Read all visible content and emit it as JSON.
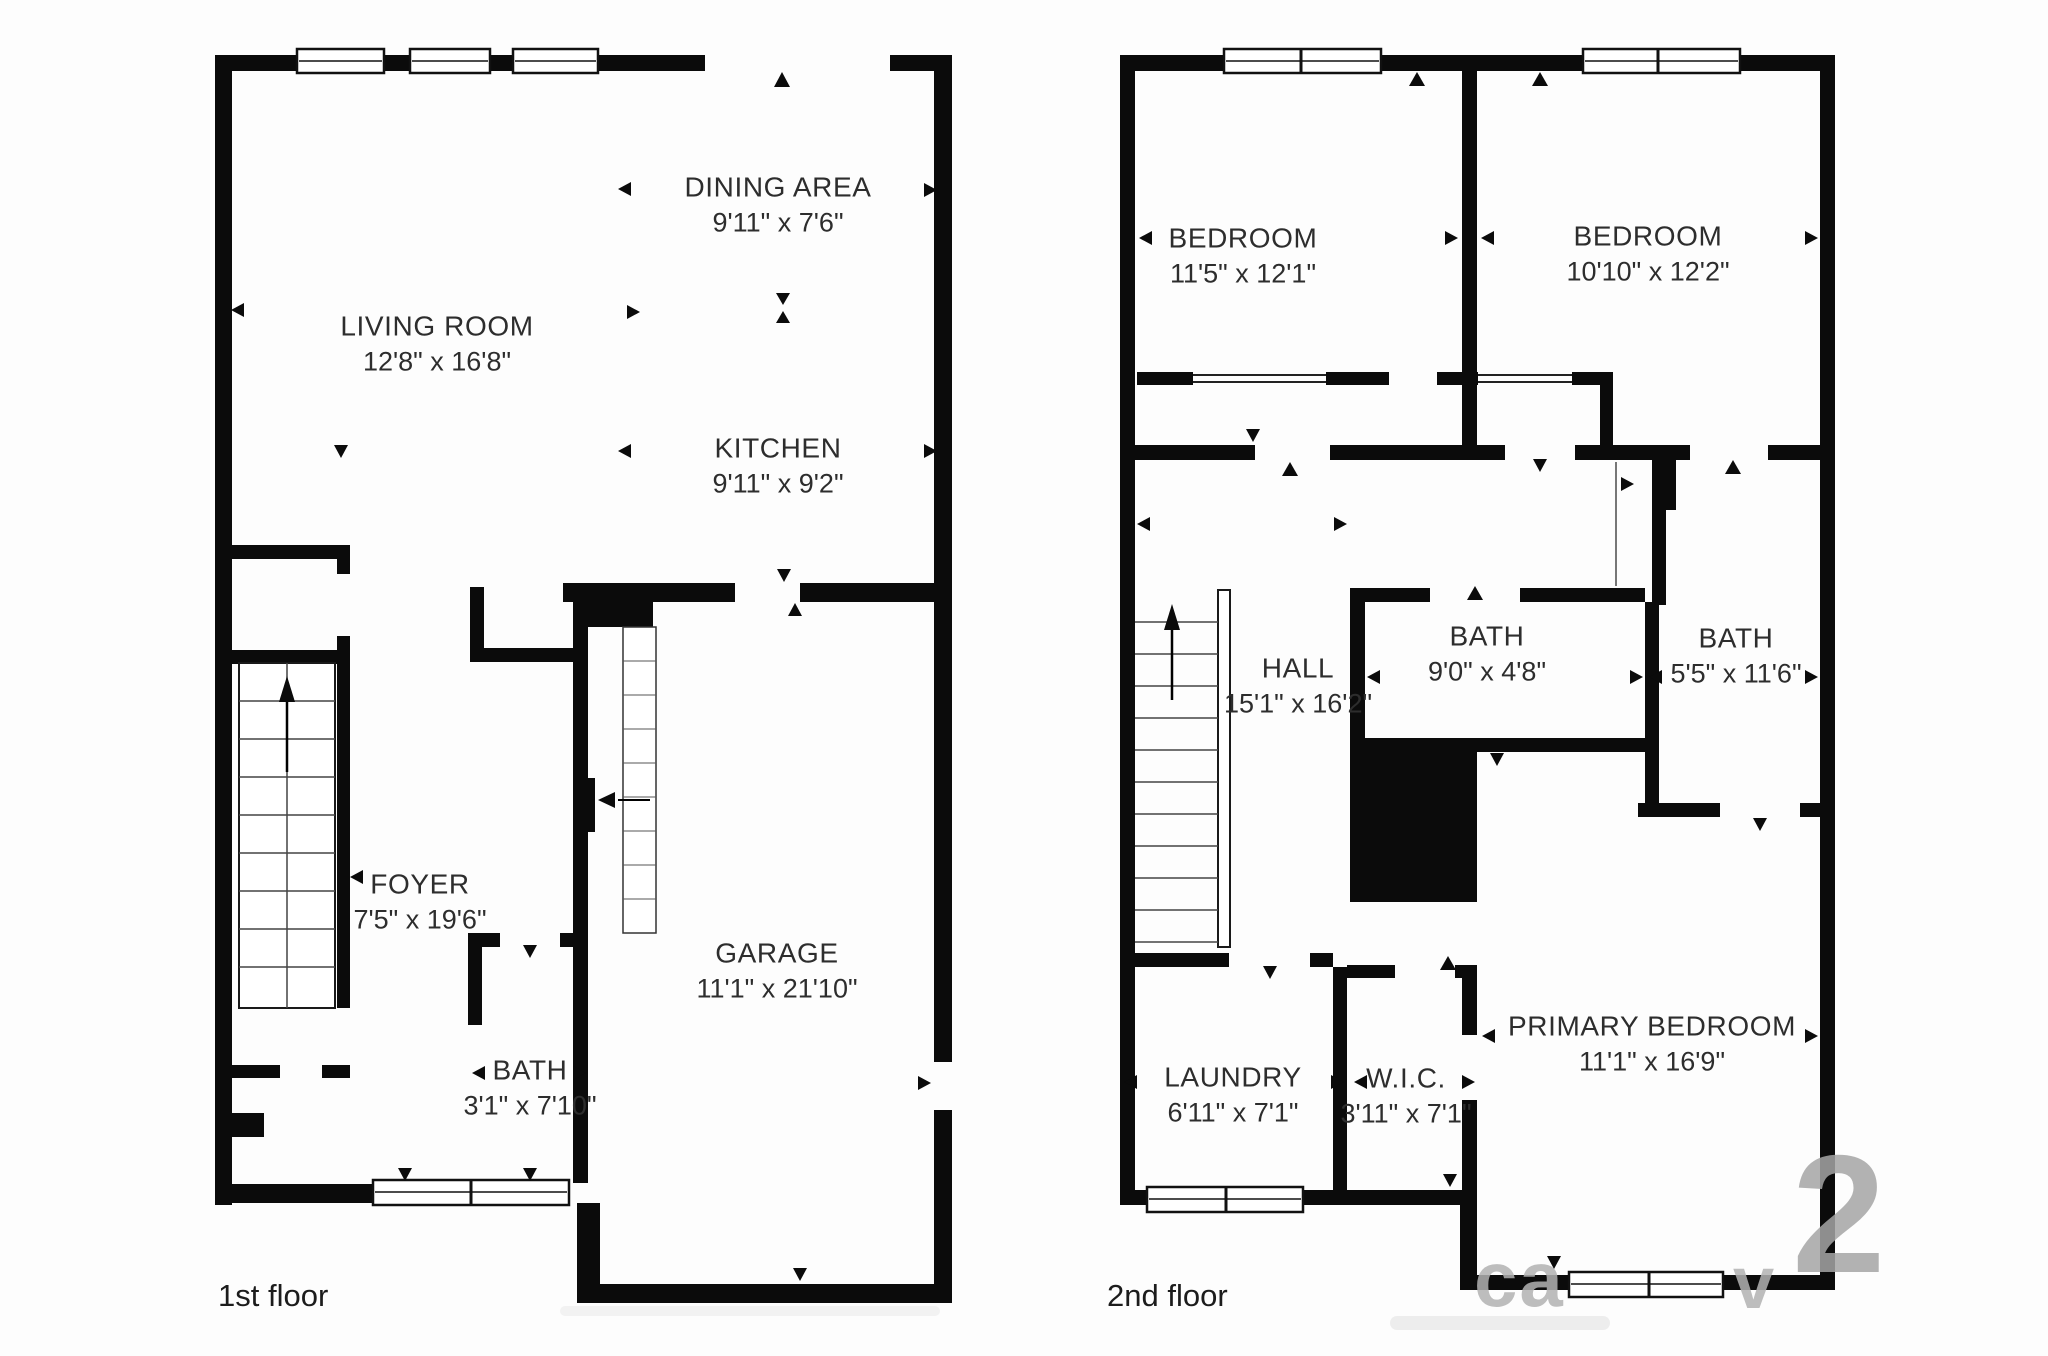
{
  "floor1": {
    "label": "1st floor",
    "rooms": [
      {
        "name": "DINING AREA",
        "dims": "9'11\" x 7'6\""
      },
      {
        "name": "LIVING ROOM",
        "dims": "12'8\" x 16'8\""
      },
      {
        "name": "KITCHEN",
        "dims": "9'11\" x 9'2\""
      },
      {
        "name": "FOYER",
        "dims": "7'5\" x 19'6\""
      },
      {
        "name": "BATH",
        "dims": "3'1\" x 7'10\""
      },
      {
        "name": "GARAGE",
        "dims": "11'1\" x 21'10\""
      }
    ]
  },
  "floor2": {
    "label": "2nd floor",
    "rooms": [
      {
        "name": "BEDROOM",
        "dims": "11'5\" x 12'1\""
      },
      {
        "name": "BEDROOM",
        "dims": "10'10\" x 12'2\""
      },
      {
        "name": "HALL",
        "dims": "15'1\" x 16'2\""
      },
      {
        "name": "BATH",
        "dims": "9'0\" x 4'8\""
      },
      {
        "name": "BATH",
        "dims": "5'5\" x 11'6\""
      },
      {
        "name": "LAUNDRY",
        "dims": "6'11\" x 7'1\""
      },
      {
        "name": "W.I.C.",
        "dims": "3'11\" x 7'1\""
      },
      {
        "name": "PRIMARY BEDROOM",
        "dims": "11'1\" x 16'9\""
      }
    ]
  },
  "watermark": {
    "fragments": [
      "ca",
      "v",
      "2"
    ]
  },
  "colors": {
    "wall": "#0b0b0b",
    "text": "#2d2d2d",
    "watermark": "#b2b2b2"
  }
}
